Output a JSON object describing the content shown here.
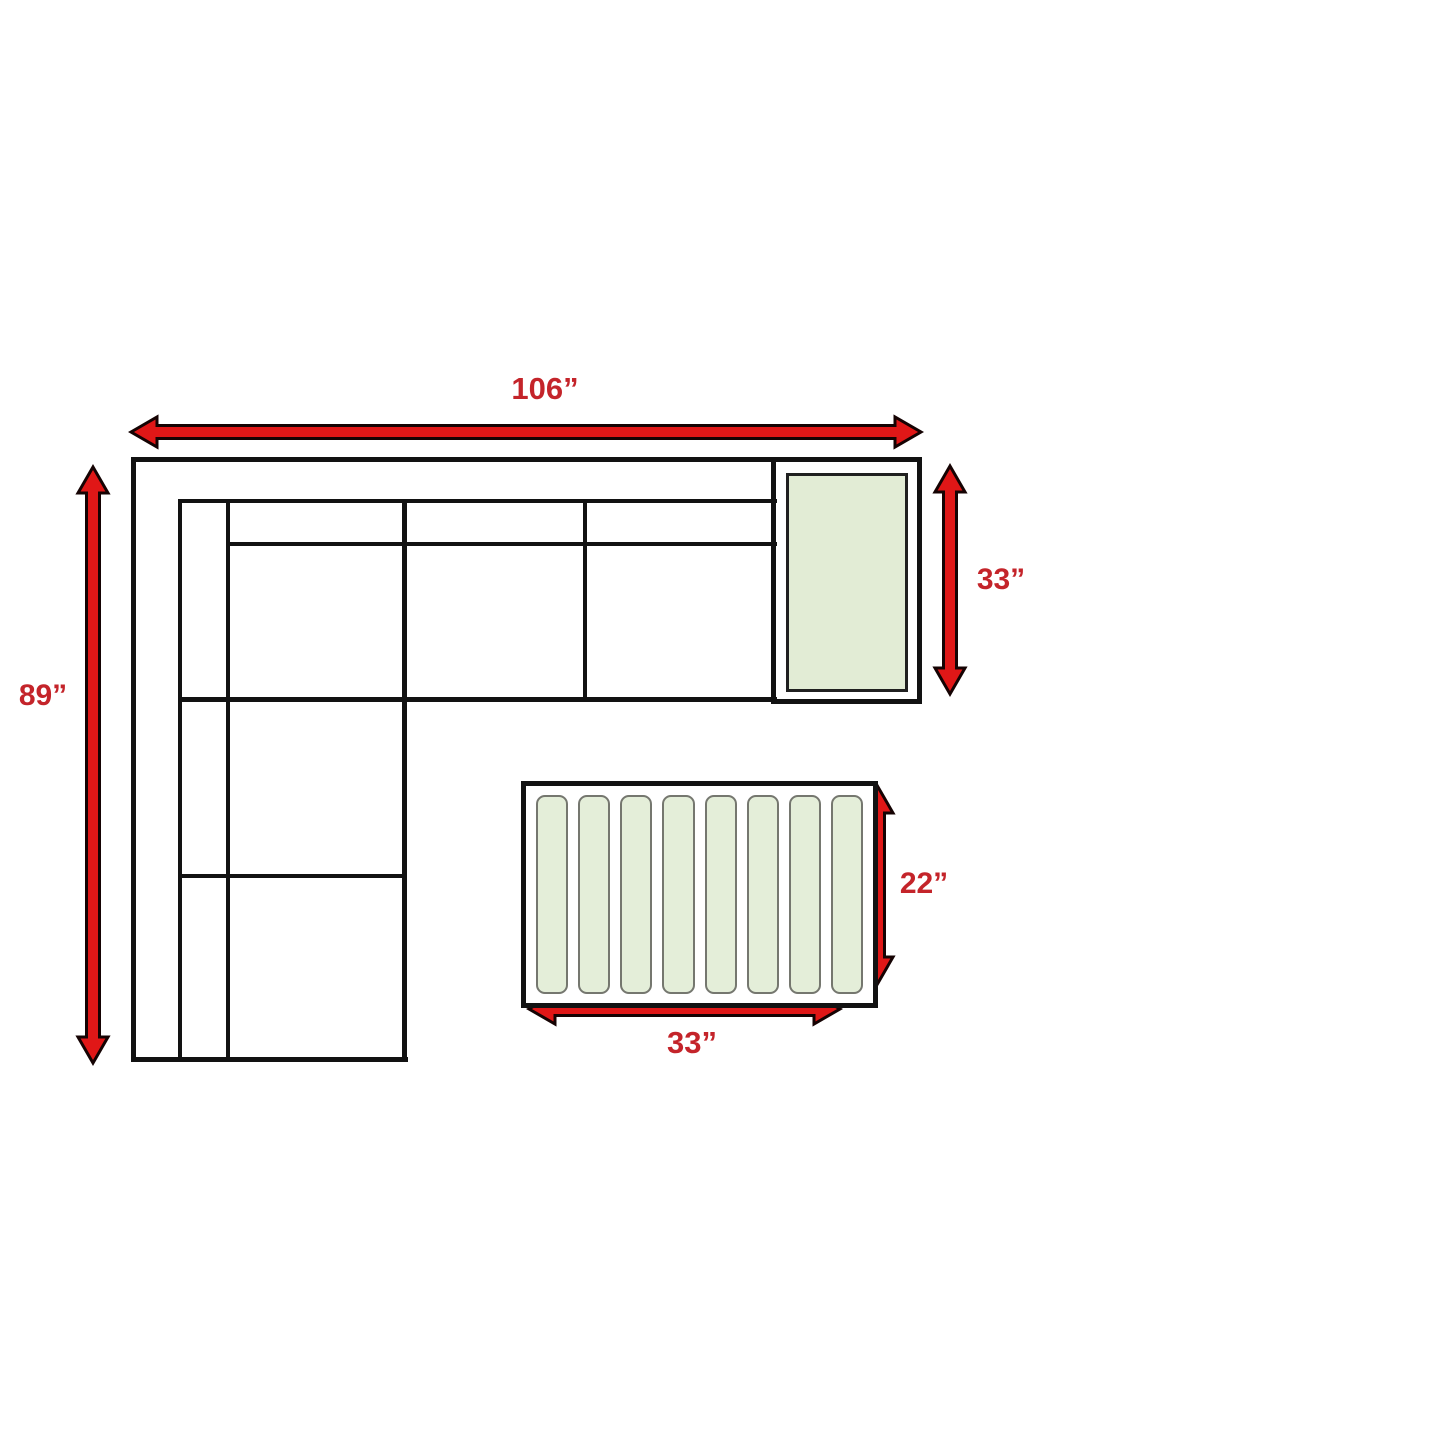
{
  "diagram": {
    "type": "furniture-dimension-diagram",
    "items": {
      "sectional_sofa": "L-shaped sectional sofa outline",
      "end_table": "end table with green top",
      "coffee_table": "slatted coffee table"
    },
    "dimensions": {
      "overall_width": "106”",
      "overall_depth": "89”",
      "end_table_depth": "33”",
      "coffee_table_depth": "22”",
      "coffee_table_width": "33”"
    },
    "coffee_table": {
      "slat_count": 8
    },
    "colors": {
      "background": "#ffffff",
      "line_black": "#121212",
      "arrow_red": "#e01717",
      "arrow_outline": "#150303",
      "label_red": "#c4242a",
      "table_green": "#e2ecd5",
      "table_green_border": "#202020",
      "slat_green": "#e4eed9",
      "slat_border": "#75776f"
    }
  }
}
